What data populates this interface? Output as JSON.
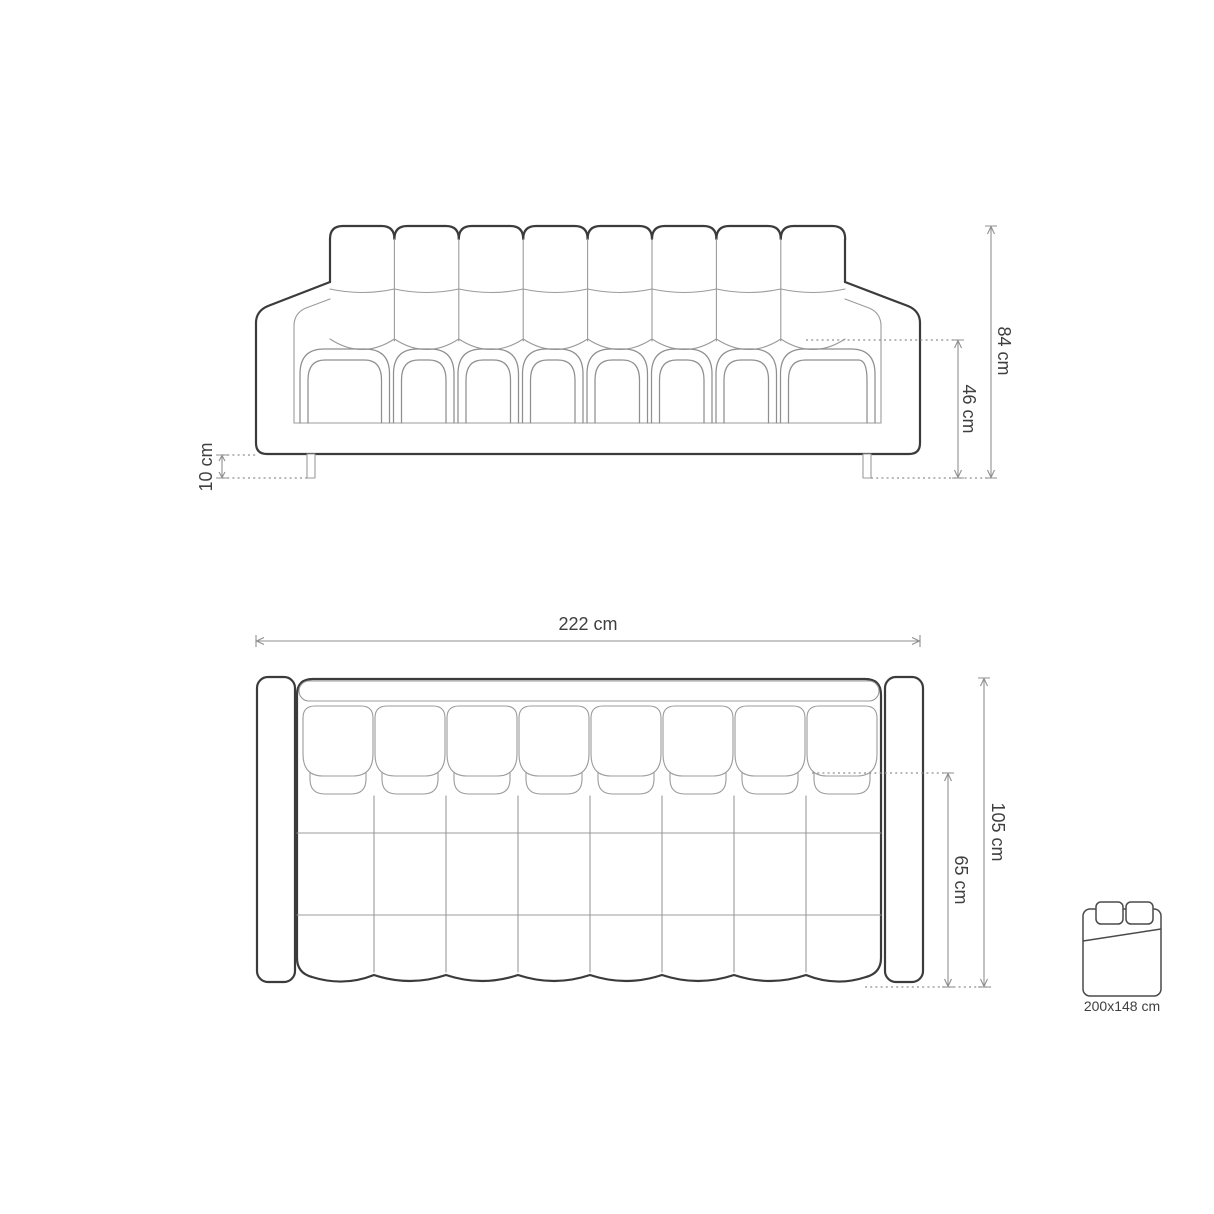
{
  "canvas": {
    "background": "#ffffff"
  },
  "palette": {
    "outline_strong": "#3b3b3b",
    "outline_soft": "#9b9b9b",
    "dimension_lines": "#8f8f8f",
    "label_text": "#3f3f3f"
  },
  "front_view": {
    "overall_height": {
      "label": "84 cm"
    },
    "seat_height": {
      "label": "46 cm"
    },
    "leg_height": {
      "label": "10 cm"
    }
  },
  "top_view": {
    "overall_width": {
      "label": "222 cm"
    },
    "overall_depth": {
      "label": "105 cm"
    },
    "seat_depth": {
      "label": "65 cm"
    }
  },
  "sleeping_area": {
    "size_label": "200x148 cm"
  }
}
